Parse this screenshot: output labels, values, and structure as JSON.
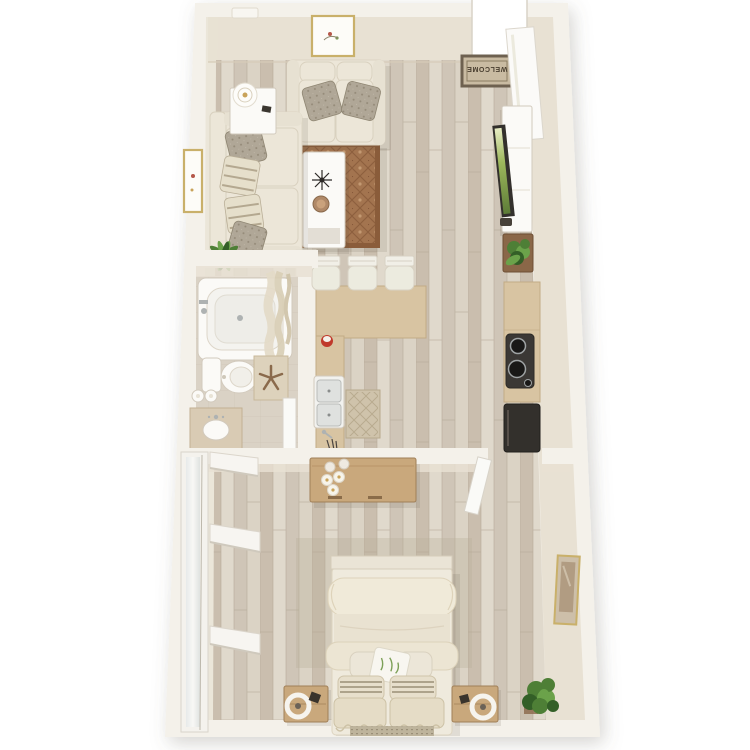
{
  "scene": {
    "title": "3D top-down floor plan render — one-bedroom apartment",
    "welcome_mat_text": "WELCOME"
  },
  "palette": {
    "bg": "#ffffff",
    "wall_top": "#f4f1ea",
    "wall_face": "#e8e1d3",
    "floor_mid": "#cfc5b6",
    "floor_light": "#e2dccf",
    "floor_base": "#d6ccbd",
    "floor_dark": "#bfb3a2",
    "plank_line": "#b3a795",
    "bath_floor": "#dad2c5",
    "tile_line": "#c6bcab",
    "fixture_white": "#fbfaf7",
    "fixture_stroke": "#d2cabd",
    "counter_tan": "#d8c4a2",
    "counter_edge": "#c2ab85",
    "cream_fabric": "#ece6d8",
    "pillow_gray": "#b0a797",
    "rug_field": "#a3744f",
    "rug_border": "#8a5c3a",
    "wood": "#c9a87c",
    "wood_dark": "#a07f58",
    "appliance_dark": "#33302c",
    "tv_screen_green": "#9db85c",
    "plant": "#4e7f36",
    "plant_deep": "#335f27",
    "mat_field": "#c9bba2",
    "mat_border": "#6e6150",
    "mat_text": "#4a3f30",
    "frame_gold": "#c9b06a"
  },
  "rooms": {
    "living_room": {
      "name": "Living Room",
      "items": [
        "loveseat",
        "sofa",
        "throw pillows",
        "side table with lamp",
        "coffee table with decor",
        "area rug",
        "wall art",
        "houseplant"
      ]
    },
    "entry": {
      "name": "Entry",
      "items": [
        "open entry door",
        "welcome mat"
      ]
    },
    "kitchen": {
      "name": "Kitchen",
      "items": [
        "TV console with TV",
        "planter box",
        "counter with cooktop",
        "refrigerator",
        "peninsula counter with double sink",
        "three bar stools",
        "patterned kitchen mat"
      ]
    },
    "bathroom": {
      "name": "Bathroom",
      "items": [
        "bathtub with shower curtain",
        "toilet",
        "vanity with sink",
        "starfish bath mat",
        "rolled towels"
      ]
    },
    "bedroom": {
      "name": "Bedroom",
      "items": [
        "bed with layered pillows",
        "two nightstands with ring lamps",
        "wood console with candles and jars",
        "wall shelves",
        "sliding closet panel",
        "houseplant",
        "wall art"
      ]
    }
  }
}
